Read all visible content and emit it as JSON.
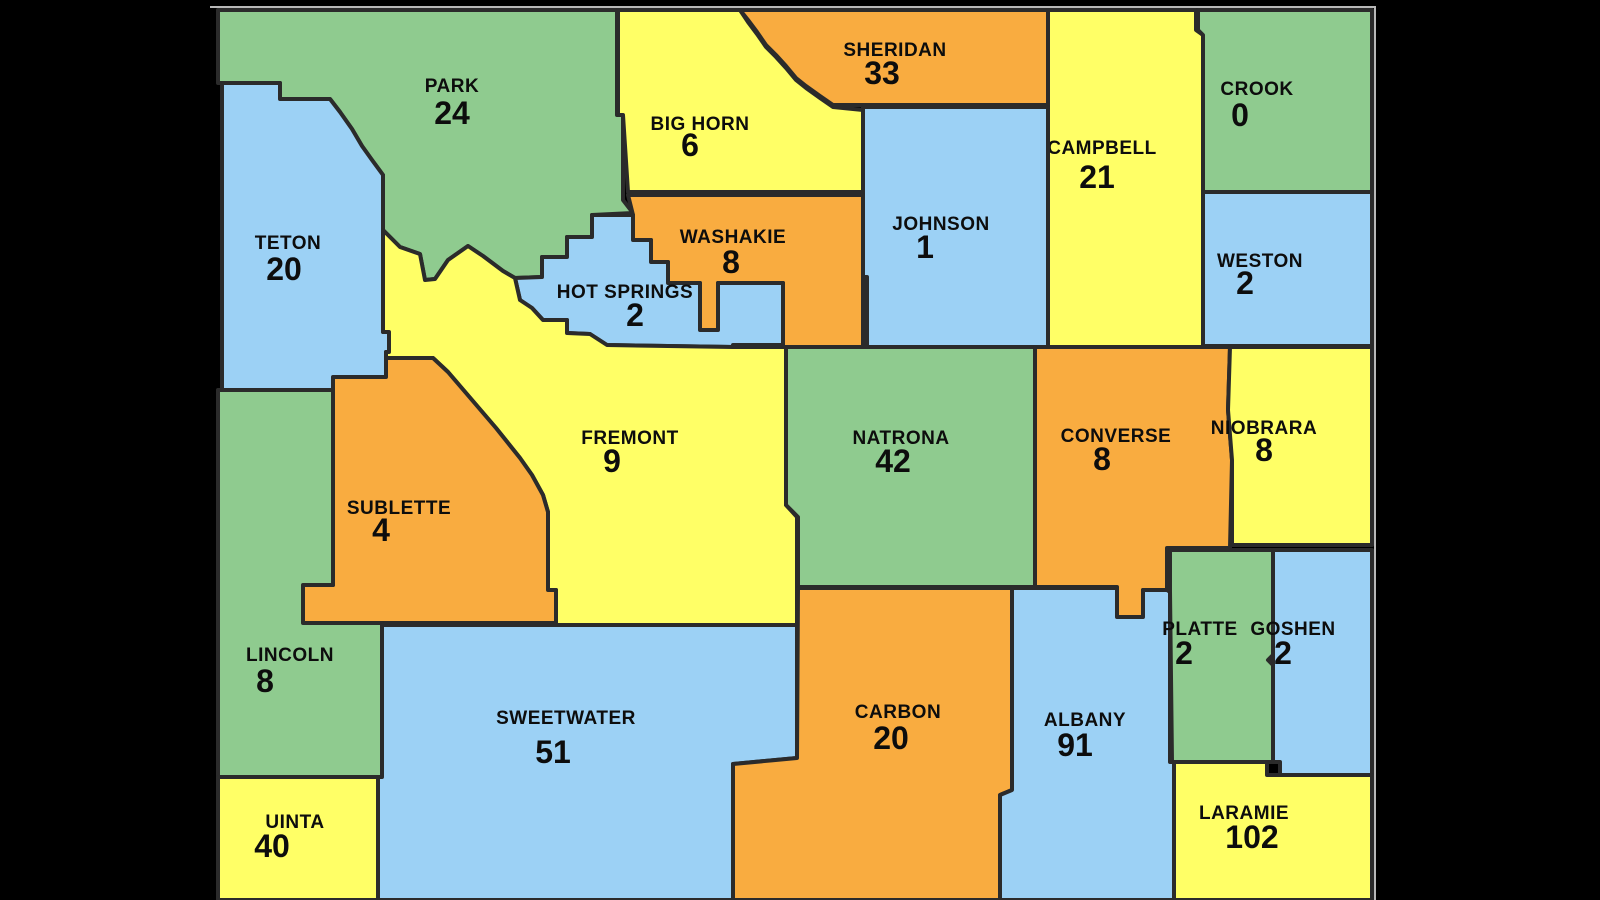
{
  "page": {
    "background": "#000000",
    "title": "Wyoming counties map"
  },
  "map": {
    "frame_color": "#b8b8b8",
    "outline_color": "#2b2b2b",
    "label_color": "#0d0d0d",
    "palette": {
      "green": "#8fcb8f",
      "blue": "#9cd1f5",
      "yellow": "#ffff66",
      "orange": "#f9ac40"
    },
    "counties": [
      {
        "name": "PARK",
        "value": "24",
        "color": "green"
      },
      {
        "name": "BIG HORN",
        "value": "6",
        "color": "yellow"
      },
      {
        "name": "SHERIDAN",
        "value": "33",
        "color": "orange"
      },
      {
        "name": "CAMPBELL",
        "value": "21",
        "color": "yellow"
      },
      {
        "name": "CROOK",
        "value": "0",
        "color": "green"
      },
      {
        "name": "JOHNSON",
        "value": "1",
        "color": "blue"
      },
      {
        "name": "WESTON",
        "value": "2",
        "color": "blue"
      },
      {
        "name": "TETON",
        "value": "20",
        "color": "blue"
      },
      {
        "name": "WASHAKIE",
        "value": "8",
        "color": "orange"
      },
      {
        "name": "HOT SPRINGS",
        "value": "2",
        "color": "blue"
      },
      {
        "name": "FREMONT",
        "value": "9",
        "color": "yellow"
      },
      {
        "name": "NATRONA",
        "value": "42",
        "color": "green"
      },
      {
        "name": "CONVERSE",
        "value": "8",
        "color": "orange"
      },
      {
        "name": "NIOBRARA",
        "value": "8",
        "color": "yellow"
      },
      {
        "name": "SUBLETTE",
        "value": "4",
        "color": "orange"
      },
      {
        "name": "LINCOLN",
        "value": "8",
        "color": "green"
      },
      {
        "name": "SWEETWATER",
        "value": "51",
        "color": "blue"
      },
      {
        "name": "CARBON",
        "value": "20",
        "color": "orange"
      },
      {
        "name": "ALBANY",
        "value": "91",
        "color": "blue"
      },
      {
        "name": "PLATTE",
        "value": "2",
        "color": "green"
      },
      {
        "name": "GOSHEN",
        "value": "2",
        "color": "blue"
      },
      {
        "name": "UINTA",
        "value": "40",
        "color": "yellow"
      },
      {
        "name": "LARAMIE",
        "value": "102",
        "color": "yellow"
      }
    ]
  }
}
